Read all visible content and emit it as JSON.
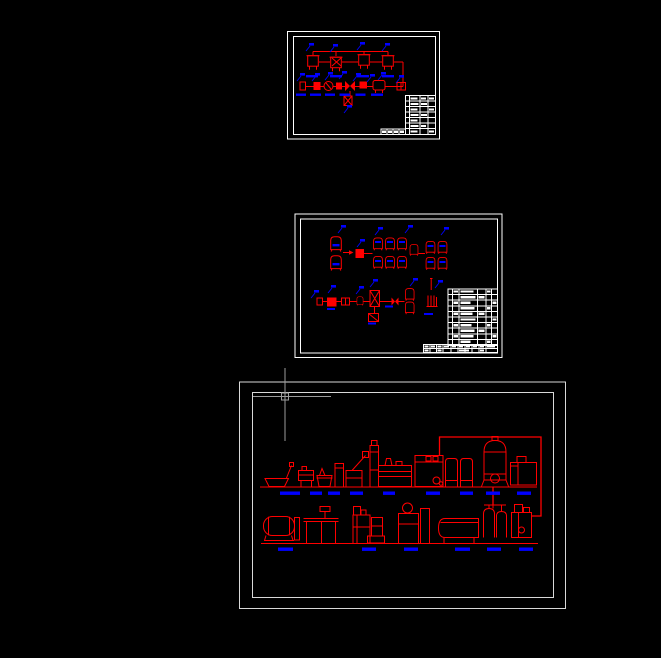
{
  "app": {
    "type": "cad-model-space-viewport",
    "background": "#000000",
    "legible_text": false
  },
  "palette": {
    "background": "#000000",
    "entity_red": "#ff0000",
    "annotation_blue": "#0000ff",
    "frame_white": "#ffffff",
    "frame_gray": "#d9d9d9",
    "cursor_gray": "#9c9c9c"
  },
  "cursor": {
    "kind": "crosshair-with-pickbox",
    "x": 285,
    "y": 396,
    "pickbox_size": 7
  },
  "sheets": [
    {
      "id": "sheet-top",
      "position": "top-center",
      "frame_color": "#ffffff",
      "content": "process flow diagram: red tanks and pump line symbols with blue leader labels and blue dashed ground marks",
      "title_block": {
        "location": "bottom-right",
        "rows": 7,
        "columns": 4,
        "text_legible": false
      }
    },
    {
      "id": "sheet-middle",
      "position": "middle-center",
      "frame_color": "#ffffff",
      "content": "equipment schematic: two process lines of red vessels and pumps with blue leader labels",
      "equipment_table": {
        "location": "right",
        "rows": 10,
        "columns": 6,
        "text_legible": false
      },
      "title_strip": {
        "location": "bottom",
        "rows": 2,
        "text_legible": false
      }
    },
    {
      "id": "sheet-bottom",
      "position": "bottom-center",
      "frame_color": "#d9d9d9",
      "content": "plant elevation layout: two rows of red machine silhouettes on ground lines with blue dashed hatch marks and a red pipe run on the right",
      "ground_lines": 2
    }
  ]
}
